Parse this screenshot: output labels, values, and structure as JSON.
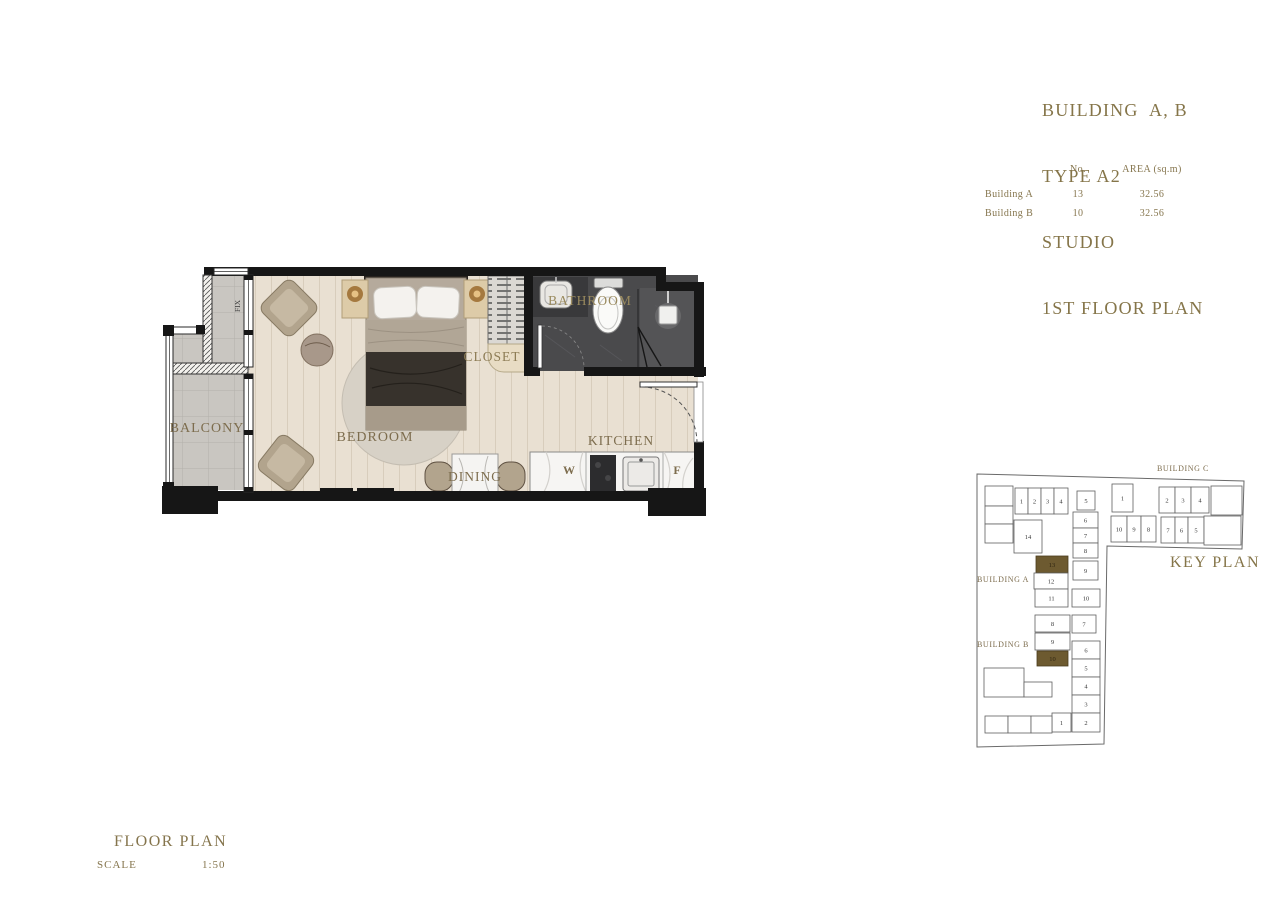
{
  "title_block": {
    "lines": [
      "BUILDING  A, B",
      "TYPE A2",
      "STUDIO",
      "1ST FLOOR PLAN"
    ]
  },
  "area_table": {
    "headers": {
      "no": "No.",
      "area": "AREA (sq.m)"
    },
    "rows": [
      {
        "name": "Building A",
        "no": "13",
        "area": "32.56"
      },
      {
        "name": "Building B",
        "no": "10",
        "area": "32.56"
      }
    ]
  },
  "floor_plan": {
    "rooms": {
      "balcony": "BALCONY",
      "bedroom": "BEDROOM",
      "closet": "CLOSET",
      "bathroom": "BATHROOM",
      "kitchen": "KITCHEN",
      "dining": "DINING",
      "washer": "W",
      "fridge": "F",
      "fix": "FIX"
    }
  },
  "key_plan": {
    "title": "KEY PLAN",
    "building_a": "BUILDING A",
    "building_b": "BUILDING B",
    "building_c": "BUILDING C",
    "highlight_color": "#6d5a30",
    "units": [
      {
        "b": "A",
        "n": "",
        "x": 985,
        "y": 486,
        "w": 28,
        "h": 20
      },
      {
        "b": "A",
        "n": "",
        "x": 985,
        "y": 506,
        "w": 28,
        "h": 18
      },
      {
        "b": "A",
        "n": "",
        "x": 985,
        "y": 524,
        "w": 28,
        "h": 19
      },
      {
        "b": "A",
        "n": "1",
        "x": 1015,
        "y": 488,
        "w": 13,
        "h": 26
      },
      {
        "b": "A",
        "n": "2",
        "x": 1028,
        "y": 488,
        "w": 13,
        "h": 26
      },
      {
        "b": "A",
        "n": "3",
        "x": 1041,
        "y": 488,
        "w": 13,
        "h": 26
      },
      {
        "b": "A",
        "n": "4",
        "x": 1054,
        "y": 488,
        "w": 14,
        "h": 26
      },
      {
        "b": "A",
        "n": "5",
        "x": 1077,
        "y": 491,
        "w": 18,
        "h": 19
      },
      {
        "b": "A",
        "n": "6",
        "x": 1073,
        "y": 512,
        "w": 25,
        "h": 16
      },
      {
        "b": "A",
        "n": "7",
        "x": 1073,
        "y": 528,
        "w": 25,
        "h": 15
      },
      {
        "b": "A",
        "n": "8",
        "x": 1073,
        "y": 543,
        "w": 25,
        "h": 15
      },
      {
        "b": "A",
        "n": "9",
        "x": 1073,
        "y": 561,
        "w": 25,
        "h": 19
      },
      {
        "b": "A",
        "n": "14",
        "x": 1014,
        "y": 520,
        "w": 28,
        "h": 33
      },
      {
        "b": "A",
        "n": "13",
        "x": 1036,
        "y": 556,
        "w": 32,
        "h": 17,
        "hl": true
      },
      {
        "b": "A",
        "n": "12",
        "x": 1034,
        "y": 573,
        "w": 34,
        "h": 16
      },
      {
        "b": "A",
        "n": "11",
        "x": 1035,
        "y": 589,
        "w": 33,
        "h": 18
      },
      {
        "b": "A",
        "n": "10",
        "x": 1072,
        "y": 589,
        "w": 28,
        "h": 18
      },
      {
        "b": "B",
        "n": "8",
        "x": 1035,
        "y": 615,
        "w": 35,
        "h": 17
      },
      {
        "b": "B",
        "n": "7",
        "x": 1072,
        "y": 615,
        "w": 24,
        "h": 18
      },
      {
        "b": "B",
        "n": "9",
        "x": 1035,
        "y": 633,
        "w": 35,
        "h": 17
      },
      {
        "b": "B",
        "n": "10",
        "x": 1037,
        "y": 651,
        "w": 31,
        "h": 15,
        "hl": true
      },
      {
        "b": "B",
        "n": "6",
        "x": 1072,
        "y": 641,
        "w": 28,
        "h": 18
      },
      {
        "b": "B",
        "n": "5",
        "x": 1072,
        "y": 659,
        "w": 28,
        "h": 18
      },
      {
        "b": "B",
        "n": "4",
        "x": 1072,
        "y": 677,
        "w": 28,
        "h": 18
      },
      {
        "b": "B",
        "n": "3",
        "x": 1072,
        "y": 695,
        "w": 28,
        "h": 18
      },
      {
        "b": "B",
        "n": "2",
        "x": 1072,
        "y": 713,
        "w": 28,
        "h": 19
      },
      {
        "b": "B",
        "n": "1",
        "x": 1052,
        "y": 713,
        "w": 19,
        "h": 19
      },
      {
        "b": "B",
        "n": "",
        "x": 984,
        "y": 668,
        "w": 40,
        "h": 29
      },
      {
        "b": "B",
        "n": "",
        "x": 1024,
        "y": 682,
        "w": 28,
        "h": 15
      },
      {
        "b": "B",
        "n": "",
        "x": 985,
        "y": 716,
        "w": 23,
        "h": 17
      },
      {
        "b": "B",
        "n": "",
        "x": 1008,
        "y": 716,
        "w": 23,
        "h": 17
      },
      {
        "b": "B",
        "n": "",
        "x": 1031,
        "y": 716,
        "w": 21,
        "h": 17
      },
      {
        "b": "C",
        "n": "1",
        "x": 1112,
        "y": 484,
        "w": 21,
        "h": 28
      },
      {
        "b": "C",
        "n": "2",
        "x": 1159,
        "y": 487,
        "w": 16,
        "h": 26
      },
      {
        "b": "C",
        "n": "3",
        "x": 1175,
        "y": 487,
        "w": 16,
        "h": 26
      },
      {
        "b": "C",
        "n": "4",
        "x": 1191,
        "y": 487,
        "w": 18,
        "h": 26
      },
      {
        "b": "C",
        "n": "",
        "x": 1211,
        "y": 486,
        "w": 31,
        "h": 29
      },
      {
        "b": "C",
        "n": "10",
        "x": 1111,
        "y": 516,
        "w": 16,
        "h": 26
      },
      {
        "b": "C",
        "n": "9",
        "x": 1127,
        "y": 516,
        "w": 14,
        "h": 26
      },
      {
        "b": "C",
        "n": "8",
        "x": 1141,
        "y": 516,
        "w": 15,
        "h": 26
      },
      {
        "b": "C",
        "n": "7",
        "x": 1161,
        "y": 517,
        "w": 14,
        "h": 26
      },
      {
        "b": "C",
        "n": "6",
        "x": 1175,
        "y": 517,
        "w": 13,
        "h": 26
      },
      {
        "b": "C",
        "n": "5",
        "x": 1188,
        "y": 517,
        "w": 16,
        "h": 26
      },
      {
        "b": "C",
        "n": "",
        "x": 1204,
        "y": 516,
        "w": 37,
        "h": 29
      }
    ]
  },
  "footer": {
    "title": "FLOOR PLAN",
    "scale_label": "SCALE",
    "scale_value": "1:50"
  },
  "colors": {
    "accent": "#857549",
    "wall": "#161616",
    "wood_floor": "#e9e0d2",
    "tile_floor": "#c9c6c1",
    "bathroom_floor": "#4a4a4c"
  }
}
